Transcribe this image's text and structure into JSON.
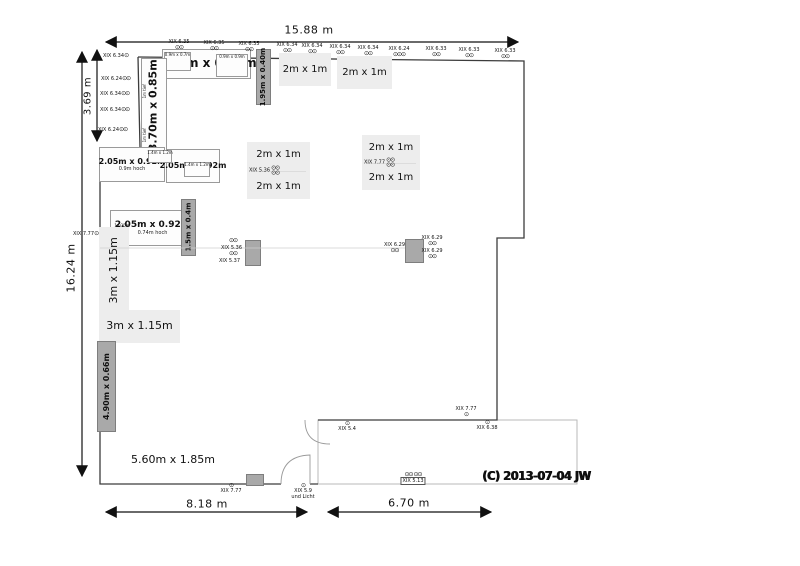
{
  "dimensions": {
    "top": {
      "label": "15.88 m"
    },
    "left_total": {
      "label": "16.24 m"
    },
    "left_upper": {
      "label": "3.69 m"
    },
    "bottom_left": {
      "label": "8.18 m"
    },
    "bottom_right": {
      "label": "6.70 m"
    }
  },
  "copyright": {
    "label": "(C) 2013-07-04 JW"
  },
  "colors": {
    "wall": "#3c3c3c",
    "light_room_outline": "#b9b9b9",
    "furniture_light": "#ededed",
    "furniture_dark": "#a9a9a9",
    "faint_line": "#cfcfcf",
    "arrow": "#111111"
  },
  "furniture": [
    {
      "name": "cabinet-350x085",
      "label": "3.50m x 0.85m",
      "x": 162,
      "y": 49,
      "w": 89,
      "h": 30,
      "style": "outline",
      "bold": true,
      "size": 12
    },
    {
      "name": "cabinet-sub-left",
      "label": "0.9m x 0.7m",
      "x": 164,
      "y": 52,
      "w": 27,
      "h": 19,
      "style": "outline",
      "size": 4,
      "valign": "top"
    },
    {
      "name": "cabinet-sub-right",
      "label": "0.9m x 0.9m",
      "x": 216,
      "y": 54,
      "w": 32,
      "h": 23,
      "style": "outline",
      "size": 4,
      "valign": "top"
    },
    {
      "name": "shelf-195x040",
      "label": "1.95m x 0.40m",
      "x": 256,
      "y": 49,
      "w": 15,
      "h": 56,
      "style": "dark",
      "rotated": true,
      "bold": true,
      "size": 7
    },
    {
      "name": "table-2x1-a",
      "label": "2m x 1m",
      "x": 279,
      "y": 53,
      "w": 52,
      "h": 33,
      "style": "fill",
      "size": 10
    },
    {
      "name": "table-2x1-b",
      "label": "2m x 1m",
      "x": 337,
      "y": 56,
      "w": 55,
      "h": 33,
      "style": "fill",
      "size": 10
    },
    {
      "name": "wardrobe-370x085",
      "label": "3.70m x 0.85m",
      "x": 141,
      "y": 58,
      "w": 26,
      "h": 95,
      "style": "outline",
      "rotated": true,
      "bold": true,
      "size": 11
    },
    {
      "name": "wardrobe-note-top",
      "label": "1m tief",
      "x": 141,
      "y": 78,
      "w": 9,
      "h": 26,
      "style": "none",
      "rotated": true,
      "size": 4
    },
    {
      "name": "wardrobe-note-bottom",
      "label": "1m tief",
      "x": 141,
      "y": 122,
      "w": 9,
      "h": 26,
      "style": "none",
      "rotated": true,
      "size": 4
    },
    {
      "name": "sideboard-a",
      "label": "2.05m x 0.92m",
      "sub": "0.9m hoch",
      "x": 99,
      "y": 147,
      "w": 66,
      "h": 35,
      "style": "outline",
      "bold": true,
      "size": 8,
      "subSize": 5
    },
    {
      "name": "sideboard-b",
      "label": "2.05m x 0.92m",
      "x": 166,
      "y": 149,
      "w": 54,
      "h": 34,
      "style": "outline",
      "bold": true,
      "size": 8
    },
    {
      "name": "sideboard-sub-1",
      "label": "1.4m x 1.2m",
      "x": 148,
      "y": 150,
      "w": 24,
      "h": 13,
      "style": "outline",
      "size": 4,
      "valign": "top"
    },
    {
      "name": "sideboard-sub-2",
      "label": "1.4m x 1.2m",
      "x": 184,
      "y": 162,
      "w": 26,
      "h": 15,
      "style": "outline",
      "size": 4,
      "valign": "top"
    },
    {
      "name": "sideboard-c",
      "label": "2.05m x 0.92m",
      "sub": "0.74m hoch",
      "x": 110,
      "y": 210,
      "w": 85,
      "h": 36,
      "style": "outline",
      "bold": true,
      "size": 9,
      "subSize": 5
    },
    {
      "name": "sideboard-c-note",
      "label": "1.035m",
      "sub": "1.2m",
      "x": 111,
      "y": 221,
      "w": 22,
      "h": 16,
      "style": "none",
      "size": 4,
      "subSize": 4
    },
    {
      "name": "shelf-15x04",
      "label": "1.5m x 0.4m",
      "x": 181,
      "y": 199,
      "w": 15,
      "h": 57,
      "style": "dark",
      "rotated": true,
      "bold": true,
      "size": 7
    },
    {
      "name": "area-3m-vertical",
      "label": "3m x 1.15m",
      "x": 99,
      "y": 227,
      "w": 30,
      "h": 86,
      "style": "fill",
      "rotated": true,
      "size": 11
    },
    {
      "name": "area-3m-horizontal",
      "label": "3m x 1.15m",
      "x": 99,
      "y": 310,
      "w": 81,
      "h": 33,
      "style": "fill",
      "size": 11
    },
    {
      "name": "shelf-490x066",
      "label": "4.90m x 0.66m",
      "x": 97,
      "y": 341,
      "w": 19,
      "h": 91,
      "style": "dark",
      "rotated": true,
      "bold": true,
      "size": 8
    },
    {
      "name": "area-560-label",
      "label": "5.60m x 1.85m",
      "x": 133,
      "y": 452,
      "w": 80,
      "h": 16,
      "style": "none",
      "size": 11
    },
    {
      "name": "utility-box-a",
      "label": "",
      "x": 245,
      "y": 240,
      "w": 16,
      "h": 26,
      "style": "dark"
    },
    {
      "name": "utility-box-b",
      "label": "",
      "x": 405,
      "y": 239,
      "w": 19,
      "h": 24,
      "style": "dark"
    },
    {
      "name": "utility-box-c",
      "label": "",
      "x": 246,
      "y": 474,
      "w": 18,
      "h": 12,
      "style": "dark"
    }
  ],
  "pairs": [
    {
      "name": "table-pair-center",
      "x": 247,
      "y": 142,
      "w": 63,
      "h": 57,
      "top": "2m x 1m",
      "bottom": "2m x 1m",
      "mid": "XIX 5.36",
      "dots": "⊙⊙",
      "dots2": "⊙⊙"
    },
    {
      "name": "table-pair-right",
      "x": 362,
      "y": 135,
      "w": 58,
      "h": 55,
      "top": "2m x 1m",
      "bottom": "2m x 1m",
      "mid": "XIX 7.77",
      "dots": "⊙⊙",
      "dots2": "⊙⊙"
    }
  ],
  "annotations": [
    {
      "t": "XIX 6.35",
      "x": 179,
      "y": 39,
      "d": "⊙⊙",
      "s": "below",
      "a": "c"
    },
    {
      "t": "XIX 6.35",
      "x": 214,
      "y": 40,
      "d": "⊙⊙",
      "s": "below",
      "a": "c"
    },
    {
      "t": "XIX 6.35",
      "x": 249,
      "y": 41,
      "d": "⊙⊙",
      "s": "below",
      "a": "c"
    },
    {
      "t": "XIX 6.34",
      "x": 287,
      "y": 42,
      "d": "⊙⊙",
      "s": "below",
      "a": "c"
    },
    {
      "t": "XIX 6.34",
      "x": 312,
      "y": 43,
      "d": "⊙⊙",
      "s": "below",
      "a": "c"
    },
    {
      "t": "XIX 6.34",
      "x": 340,
      "y": 44,
      "d": "⊙⊙",
      "s": "below",
      "a": "c"
    },
    {
      "t": "XIX 6.34",
      "x": 368,
      "y": 45,
      "d": "⊙⊙",
      "s": "below",
      "a": "c"
    },
    {
      "t": "XIX 6.24",
      "x": 399,
      "y": 46,
      "d": "⊙⊙⊙",
      "s": "below",
      "a": "c"
    },
    {
      "t": "XIX 6.33",
      "x": 436,
      "y": 46,
      "d": "⊙⊙",
      "s": "below",
      "a": "c"
    },
    {
      "t": "XIX 6.33",
      "x": 469,
      "y": 47,
      "d": "⊙⊙",
      "s": "below",
      "a": "c"
    },
    {
      "t": "XIX 6.33",
      "x": 505,
      "y": 48,
      "d": "⊙⊙",
      "s": "below",
      "a": "c"
    },
    {
      "t": "XIX 6.34",
      "x": 103,
      "y": 53,
      "d": "⊙",
      "s": "right",
      "a": "l"
    },
    {
      "t": "XIX 6.24",
      "x": 101,
      "y": 76,
      "d": "⊙⊙",
      "s": "right",
      "a": "l"
    },
    {
      "t": "XIX 6.34",
      "x": 100,
      "y": 91,
      "d": "⊙⊙",
      "s": "right",
      "a": "l"
    },
    {
      "t": "XIX 6.34",
      "x": 100,
      "y": 107,
      "d": "⊙⊙",
      "s": "right",
      "a": "l"
    },
    {
      "t": "XIX 6.24",
      "x": 98,
      "y": 127,
      "d": "⊙⊙",
      "s": "right",
      "a": "l"
    },
    {
      "t": "XIX 7.77",
      "x": 73,
      "y": 231,
      "d": "⊙",
      "s": "right",
      "a": "l"
    },
    {
      "t": "",
      "x": 229,
      "y": 238,
      "d": "⊙⊙",
      "s": "only",
      "a": "l"
    },
    {
      "t": "XIX 5.36",
      "x": 221,
      "y": 245,
      "d": "",
      "s": "none",
      "a": "l"
    },
    {
      "t": "",
      "x": 229,
      "y": 251,
      "d": "⊙⊙",
      "s": "only",
      "a": "l"
    },
    {
      "t": "XIX 5.37",
      "x": 219,
      "y": 258,
      "d": "",
      "s": "none",
      "a": "l"
    },
    {
      "t": "XIX 6.29",
      "x": 384,
      "y": 242,
      "d": "⊙⊙",
      "s": "below",
      "a": "l"
    },
    {
      "t": "XIX 6.29",
      "x": 432,
      "y": 235,
      "d": "⊙⊙",
      "s": "below",
      "a": "c"
    },
    {
      "t": "XIX 6.29",
      "x": 432,
      "y": 248,
      "d": "⊙⊙",
      "s": "below",
      "a": "c"
    },
    {
      "t": "XIX 7.77",
      "x": 466,
      "y": 406,
      "d": "⊙",
      "s": "below",
      "a": "c"
    },
    {
      "t": "XIX 5.4",
      "x": 347,
      "y": 421,
      "d": "⊙",
      "s": "above",
      "a": "c"
    },
    {
      "t": "XIX 6.38",
      "x": 487,
      "y": 420,
      "d": "⊙",
      "s": "above",
      "a": "c"
    },
    {
      "t": "XIX 7.77",
      "x": 231,
      "y": 483,
      "d": "⊙",
      "s": "above",
      "a": "c"
    },
    {
      "t": "XIX 5.9",
      "x": 303,
      "y": 483,
      "d": "⊙",
      "s": "above",
      "a": "c",
      "sub": "und Licht"
    },
    {
      "t": "XIX 5.13",
      "x": 413,
      "y": 472,
      "d": "⊙⊙ ⊙⊙",
      "s": "above",
      "a": "c",
      "boxed": true
    }
  ]
}
